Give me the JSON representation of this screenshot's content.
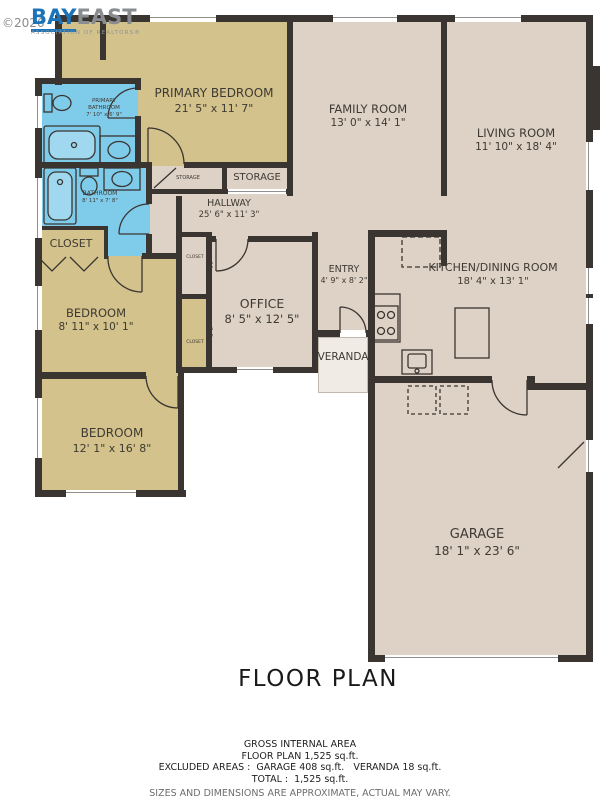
{
  "watermark": {
    "copyright": "©2026",
    "brand_bay": "BAY",
    "brand_east": "EAST",
    "brand_sub": "ASSOCIATION OF REALTORS®"
  },
  "title": "FLOOR PLAN",
  "rooms": {
    "primary_bedroom": {
      "name": "PRIMARY BEDROOM",
      "dims": "21' 5\" x 11' 7\""
    },
    "family_room": {
      "name": "FAMILY ROOM",
      "dims": "13' 0\" x 14' 1\""
    },
    "living_room": {
      "name": "LIVING ROOM",
      "dims": "11' 10\" x 18' 4\""
    },
    "primary_bathroom": {
      "name": "PRIMARY BATHROOM",
      "dims": "7' 10\" x 6' 9\""
    },
    "bathroom": {
      "name": "BATHROOM",
      "dims": "8' 11\" x 7' 8\""
    },
    "storage_small": {
      "name": "STORAGE"
    },
    "storage": {
      "name": "STORAGE"
    },
    "hallway": {
      "name": "HALLWAY",
      "dims": "25' 6\" x 11' 3\""
    },
    "closet": {
      "name": "CLOSET"
    },
    "closet_a": {
      "name": "CLOSET"
    },
    "closet_b": {
      "name": "CLOSET"
    },
    "bedroom_1": {
      "name": "BEDROOM",
      "dims": "8' 11\" x 10' 1\""
    },
    "bedroom_2": {
      "name": "BEDROOM",
      "dims": "12' 1\" x 16' 8\""
    },
    "office": {
      "name": "OFFICE",
      "dims": "8' 5\" x 12' 5\""
    },
    "entry": {
      "name": "ENTRY",
      "dims": "4' 9\" x 8' 2\""
    },
    "kitchen_dining": {
      "name": "KITCHEN/DINING ROOM",
      "dims": "18' 4\" x 13' 1\""
    },
    "veranda": {
      "name": "VERANDA"
    },
    "garage": {
      "name": "GARAGE",
      "dims": "18' 1\" x 23' 6\""
    }
  },
  "footer": {
    "line1": "GROSS INTERNAL AREA",
    "line2": "FLOOR PLAN 1,525 sq.ft.",
    "line3": "EXCLUDED AREAS :  GARAGE 408 sq.ft.   VERANDA 18 sq.ft.",
    "line4": "TOTAL :  1,525 sq.ft.",
    "disclaimer": "SIZES AND DIMENSIONS ARE APPROXIMATE, ACTUAL MAY VARY."
  },
  "colors": {
    "wall": "#3a3531",
    "bedroom_fill": "#d3c28c",
    "common_fill": "#ded2c7",
    "bath_fill": "#7fcbea",
    "veranda_fill": "#f0ebe5",
    "logo_blue": "#1b74b9",
    "logo_gray": "#8a8d90",
    "label_text": "#3e3a33"
  }
}
